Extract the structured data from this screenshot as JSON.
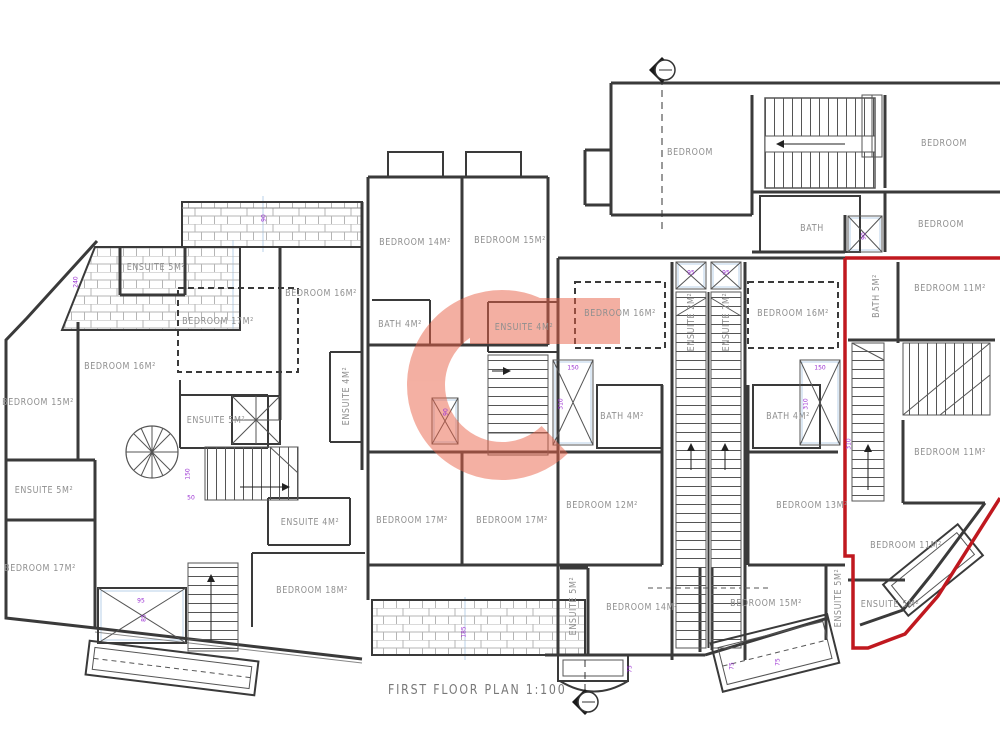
{
  "title": "FIRST FLOOR PLAN 1:100",
  "watermark": {
    "letter": "G",
    "color": "#e96147"
  },
  "colors": {
    "wall": "#3a3a3a",
    "thin": "#5a5a5a",
    "red_unit_outline": "#c0181f",
    "dimension_text": "#9a2fd2",
    "guide_line": "#b9d2ea",
    "label_text": "#8f8f8f",
    "hatch": "#b5b5b5"
  },
  "rooms": [
    {
      "label": "BEDROOM",
      "x": 690,
      "y": 152,
      "rot": 0
    },
    {
      "label": "BEDROOM",
      "x": 944,
      "y": 143,
      "rot": 0
    },
    {
      "label": "BEDROOM",
      "x": 941,
      "y": 224,
      "rot": 0
    },
    {
      "label": "BATH",
      "x": 812,
      "y": 228,
      "rot": 0
    },
    {
      "label": "BATH 5M²",
      "x": 876,
      "y": 296,
      "rot": -90
    },
    {
      "label": "BEDROOM 11M²",
      "x": 950,
      "y": 288,
      "rot": 0
    },
    {
      "label": "BEDROOM 11M²",
      "x": 950,
      "y": 452,
      "rot": 0
    },
    {
      "label": "BEDROOM 11M²",
      "x": 906,
      "y": 545,
      "rot": 0
    },
    {
      "label": "ENSUITE 5M²",
      "x": 890,
      "y": 604,
      "rot": 0
    },
    {
      "label": "ENSUITE 5M²",
      "x": 156,
      "y": 267,
      "rot": 0
    },
    {
      "label": "BEDROOM 17M²",
      "x": 218,
      "y": 321,
      "rot": 0
    },
    {
      "label": "BEDROOM 16M²",
      "x": 321,
      "y": 293,
      "rot": 0
    },
    {
      "label": "BEDROOM 16M²",
      "x": 120,
      "y": 366,
      "rot": 0
    },
    {
      "label": "BEDROOM 15M²",
      "x": 38,
      "y": 402,
      "rot": 0
    },
    {
      "label": "BEDROOM 14M²",
      "x": 415,
      "y": 242,
      "rot": 0
    },
    {
      "label": "BEDROOM 15M²",
      "x": 510,
      "y": 240,
      "rot": 0
    },
    {
      "label": "BATH 4M²",
      "x": 400,
      "y": 324,
      "rot": 0
    },
    {
      "label": "ENSUITE 4M²",
      "x": 524,
      "y": 327,
      "rot": 0
    },
    {
      "label": "ENSUITE 4M²",
      "x": 346,
      "y": 396,
      "rot": -90
    },
    {
      "label": "ENSUITE 5M²",
      "x": 216,
      "y": 420,
      "rot": 0
    },
    {
      "label": "ENSUITE 5M²",
      "x": 44,
      "y": 490,
      "rot": 0
    },
    {
      "label": "BEDROOM 17M²",
      "x": 40,
      "y": 568,
      "rot": 0
    },
    {
      "label": "ENSUITE 4M²",
      "x": 310,
      "y": 522,
      "rot": 0
    },
    {
      "label": "BEDROOM 18M²",
      "x": 312,
      "y": 590,
      "rot": 0
    },
    {
      "label": "BEDROOM 17M²",
      "x": 412,
      "y": 520,
      "rot": 0
    },
    {
      "label": "BEDROOM 17M²",
      "x": 512,
      "y": 520,
      "rot": 0
    },
    {
      "label": "BEDROOM 16M²",
      "x": 620,
      "y": 313,
      "rot": 0
    },
    {
      "label": "BATH 4M²",
      "x": 622,
      "y": 416,
      "rot": 0
    },
    {
      "label": "BEDROOM 12M²",
      "x": 602,
      "y": 505,
      "rot": 0
    },
    {
      "label": "ENSUITE 5M²",
      "x": 573,
      "y": 606,
      "rot": -90
    },
    {
      "label": "BEDROOM 14M²",
      "x": 642,
      "y": 607,
      "rot": 0
    },
    {
      "label": "ENSUITE 2M²",
      "x": 691,
      "y": 322,
      "rot": -90
    },
    {
      "label": "ENSUITE 2M²",
      "x": 726,
      "y": 322,
      "rot": -90
    },
    {
      "label": "BEDROOM 16M²",
      "x": 793,
      "y": 313,
      "rot": 0
    },
    {
      "label": "BATH 4M²",
      "x": 788,
      "y": 416,
      "rot": 0
    },
    {
      "label": "BEDROOM 13M²",
      "x": 812,
      "y": 505,
      "rot": 0
    },
    {
      "label": "BEDROOM 15M²",
      "x": 766,
      "y": 603,
      "rot": 0
    },
    {
      "label": "ENSUITE 5M²",
      "x": 838,
      "y": 598,
      "rot": -90
    }
  ],
  "dimensions": [
    {
      "text": "240",
      "x": 76,
      "y": 282,
      "rot": -90
    },
    {
      "text": "90",
      "x": 264,
      "y": 218,
      "rot": -90
    },
    {
      "text": "150",
      "x": 573,
      "y": 368,
      "rot": 0
    },
    {
      "text": "310",
      "x": 561,
      "y": 404,
      "rot": -90
    },
    {
      "text": "150",
      "x": 820,
      "y": 368,
      "rot": 0
    },
    {
      "text": "310",
      "x": 806,
      "y": 404,
      "rot": -90
    },
    {
      "text": "90",
      "x": 446,
      "y": 412,
      "rot": -90
    },
    {
      "text": "95",
      "x": 691,
      "y": 273,
      "rot": 0
    },
    {
      "text": "95",
      "x": 726,
      "y": 273,
      "rot": 0
    },
    {
      "text": "90",
      "x": 864,
      "y": 236,
      "rot": -90
    },
    {
      "text": "75",
      "x": 630,
      "y": 669,
      "rot": -90
    },
    {
      "text": "75",
      "x": 732,
      "y": 666,
      "rot": -90
    },
    {
      "text": "75",
      "x": 778,
      "y": 662,
      "rot": -90
    },
    {
      "text": "95",
      "x": 141,
      "y": 601,
      "rot": 0
    },
    {
      "text": "85",
      "x": 144,
      "y": 618,
      "rot": -90
    },
    {
      "text": "150",
      "x": 188,
      "y": 474,
      "rot": -90
    },
    {
      "text": "50",
      "x": 191,
      "y": 498,
      "rot": 0
    },
    {
      "text": "185",
      "x": 464,
      "y": 632,
      "rot": -90
    },
    {
      "text": "310",
      "x": 849,
      "y": 444,
      "rot": -90
    }
  ]
}
